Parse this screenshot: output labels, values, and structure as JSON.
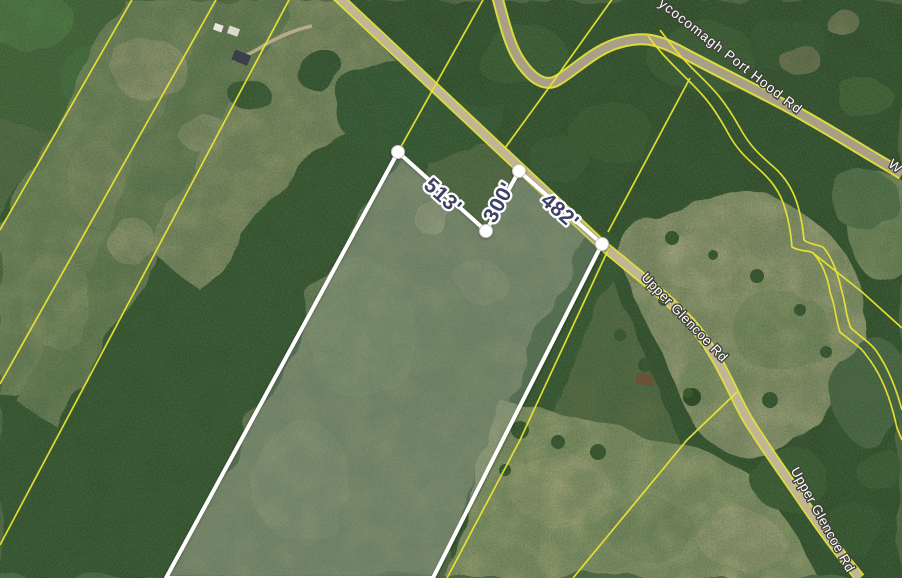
{
  "map": {
    "view": "satellite",
    "road_labels": {
      "whycocomagh_top": "ycocomagh Port Hood Rd",
      "whycocomagh_partial": "W",
      "upper_glencoe_mid": "Upper Glencoe Rd",
      "upper_glencoe_bottom": "Upper Glencoe Rd"
    },
    "parcel": {
      "measurements": {
        "northwest_edge": "513'",
        "notch_edge": "300'",
        "road_frontage": "482'"
      }
    },
    "colors": {
      "parcel_highlight": "#ffffff",
      "cadastral_line": "#e9e431",
      "measurement_text": "#3d4163",
      "road_label_text": "#ffffff",
      "road_surface": "#c0b694"
    }
  }
}
